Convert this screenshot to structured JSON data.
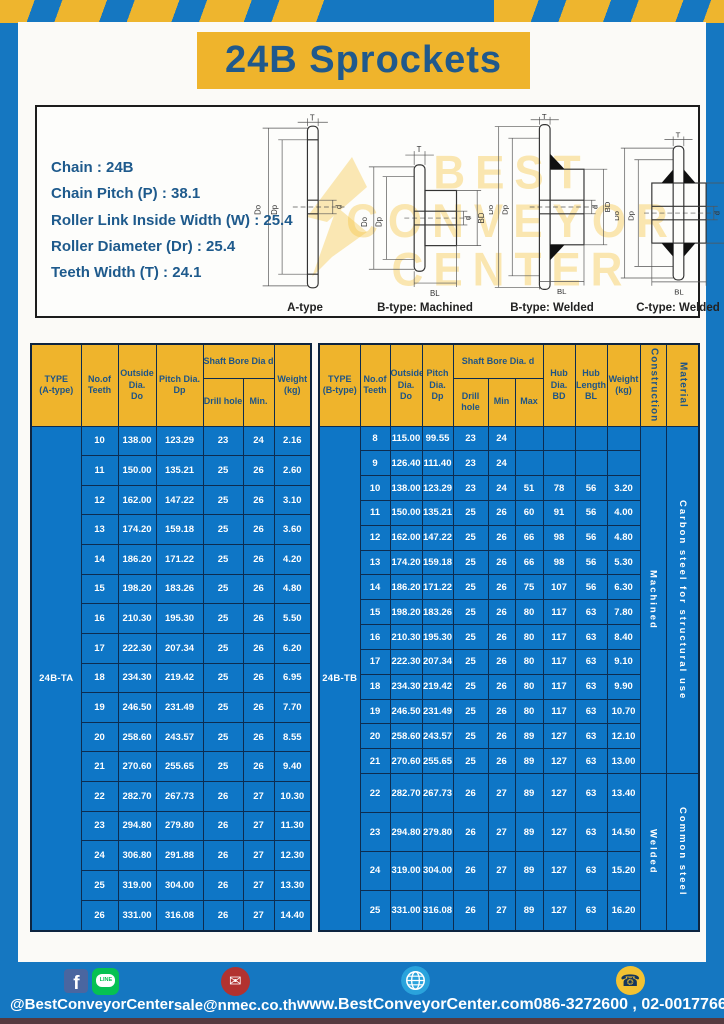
{
  "page": {
    "title": "24B Sprockets"
  },
  "specs": {
    "lines": [
      "Chain  : 24B",
      "Chain Pitch (P)  :  38.1",
      "Roller Link Inside Width (W)  :  25.4",
      "Roller Diameter (Dr)  : 25.4",
      "Teeth Width (T)  :  24.1"
    ]
  },
  "watermark": {
    "line1": "BEST",
    "line2": "CONVEYOR",
    "line3": "CENTER"
  },
  "drawings": {
    "captions": [
      "A-type",
      "B-type: Machined",
      "B-type: Welded",
      "C-type: Welded"
    ],
    "dims": {
      "t": "T",
      "do": "Do",
      "dp": "Dp",
      "d": "d",
      "bd": "BD",
      "bl": "BL"
    }
  },
  "table_a": {
    "header": {
      "type": "TYPE\n(A-type)",
      "teeth": "No.of\nTeeth",
      "outside": "Outside\nDia.\nDo",
      "pitch": "Pitch Dia.\nDp",
      "shaft": "Shaft Bore Dia d",
      "drill": "Drill hole",
      "min": "Min.",
      "weight": "Weight\n(kg)"
    },
    "type_label": "24B-TA",
    "rows": [
      [
        "10",
        "138.00",
        "123.29",
        "23",
        "24",
        "2.16"
      ],
      [
        "11",
        "150.00",
        "135.21",
        "25",
        "26",
        "2.60"
      ],
      [
        "12",
        "162.00",
        "147.22",
        "25",
        "26",
        "3.10"
      ],
      [
        "13",
        "174.20",
        "159.18",
        "25",
        "26",
        "3.60"
      ],
      [
        "14",
        "186.20",
        "171.22",
        "25",
        "26",
        "4.20"
      ],
      [
        "15",
        "198.20",
        "183.26",
        "25",
        "26",
        "4.80"
      ],
      [
        "16",
        "210.30",
        "195.30",
        "25",
        "26",
        "5.50"
      ],
      [
        "17",
        "222.30",
        "207.34",
        "25",
        "26",
        "6.20"
      ],
      [
        "18",
        "234.30",
        "219.42",
        "25",
        "26",
        "6.95"
      ],
      [
        "19",
        "246.50",
        "231.49",
        "25",
        "26",
        "7.70"
      ],
      [
        "20",
        "258.60",
        "243.57",
        "25",
        "26",
        "8.55"
      ],
      [
        "21",
        "270.60",
        "255.65",
        "25",
        "26",
        "9.40"
      ],
      [
        "22",
        "282.70",
        "267.73",
        "26",
        "27",
        "10.30"
      ],
      [
        "23",
        "294.80",
        "279.80",
        "26",
        "27",
        "11.30"
      ],
      [
        "24",
        "306.80",
        "291.88",
        "26",
        "27",
        "12.30"
      ],
      [
        "25",
        "319.00",
        "304.00",
        "26",
        "27",
        "13.30"
      ],
      [
        "26",
        "331.00",
        "316.08",
        "26",
        "27",
        "14.40"
      ]
    ]
  },
  "table_b": {
    "header": {
      "type": "TYPE\n(B-type)",
      "teeth": "No.of\nTeeth",
      "outside": "Outside\nDia.\nDo",
      "pitch": "Pitch\nDia.\nDp",
      "shaft": "Shaft Bore Dia.  d",
      "drill": "Drill hole",
      "min": "Min",
      "max": "Max",
      "hub_dia": "Hub\nDia.\nBD",
      "hub_len": "Hub\nLength\nBL",
      "weight": "Weight\n(kg)",
      "construction": "Construction",
      "material": "Material"
    },
    "type_label": "24B-TB",
    "rows": [
      [
        "8",
        "115.00",
        "99.55",
        "23",
        "24",
        "",
        "",
        "",
        ""
      ],
      [
        "9",
        "126.40",
        "111.40",
        "23",
        "24",
        "",
        "",
        "",
        ""
      ],
      [
        "10",
        "138.00",
        "123.29",
        "23",
        "24",
        "51",
        "78",
        "56",
        "3.20"
      ],
      [
        "11",
        "150.00",
        "135.21",
        "25",
        "26",
        "60",
        "91",
        "56",
        "4.00"
      ],
      [
        "12",
        "162.00",
        "147.22",
        "25",
        "26",
        "66",
        "98",
        "56",
        "4.80"
      ],
      [
        "13",
        "174.20",
        "159.18",
        "25",
        "26",
        "66",
        "98",
        "56",
        "5.30"
      ],
      [
        "14",
        "186.20",
        "171.22",
        "25",
        "26",
        "75",
        "107",
        "56",
        "6.30"
      ],
      [
        "15",
        "198.20",
        "183.26",
        "25",
        "26",
        "80",
        "117",
        "63",
        "7.80"
      ],
      [
        "16",
        "210.30",
        "195.30",
        "25",
        "26",
        "80",
        "117",
        "63",
        "8.40"
      ],
      [
        "17",
        "222.30",
        "207.34",
        "25",
        "26",
        "80",
        "117",
        "63",
        "9.10"
      ],
      [
        "18",
        "234.30",
        "219.42",
        "25",
        "26",
        "80",
        "117",
        "63",
        "9.90"
      ],
      [
        "19",
        "246.50",
        "231.49",
        "25",
        "26",
        "80",
        "117",
        "63",
        "10.70"
      ],
      [
        "20",
        "258.60",
        "243.57",
        "25",
        "26",
        "89",
        "127",
        "63",
        "12.10"
      ],
      [
        "21",
        "270.60",
        "255.65",
        "25",
        "26",
        "89",
        "127",
        "63",
        "13.00"
      ],
      [
        "22",
        "282.70",
        "267.73",
        "26",
        "27",
        "89",
        "127",
        "63",
        "13.40"
      ],
      [
        "23",
        "294.80",
        "279.80",
        "26",
        "27",
        "89",
        "127",
        "63",
        "14.50"
      ],
      [
        "24",
        "319.00",
        "304.00",
        "26",
        "27",
        "89",
        "127",
        "63",
        "15.20"
      ],
      [
        "25",
        "331.00",
        "316.08",
        "26",
        "27",
        "89",
        "127",
        "63",
        "16.20"
      ]
    ],
    "groups": [
      {
        "name": "construction-cell",
        "spans": [
          {
            "start": 0,
            "span": 14,
            "label": "Machined"
          },
          {
            "start": 14,
            "span": 4,
            "label": "Welded"
          }
        ]
      },
      {
        "name": "material-cell",
        "spans": [
          {
            "start": 0,
            "span": 14,
            "label": "Carbon  steel  for  structural  use"
          },
          {
            "start": 14,
            "span": 4,
            "label": "Common steel"
          }
        ]
      }
    ]
  },
  "footer": {
    "fb_letter": "f",
    "line_text": "LINE",
    "social_label": "@BestConveyorCenter",
    "email": "sale@nmec.co.th",
    "website": "www.BestConveyorCenter.com",
    "phones": "086-3272600 , 02-0017766",
    "icons": {
      "mail": "✉",
      "phone": "☎"
    }
  },
  "colors": {
    "blue": "#1577c1",
    "table_blue": "#0e76c6",
    "yellow": "#efb42c",
    "navy_border": "#0d2c50",
    "heading_text": "#20598c"
  }
}
